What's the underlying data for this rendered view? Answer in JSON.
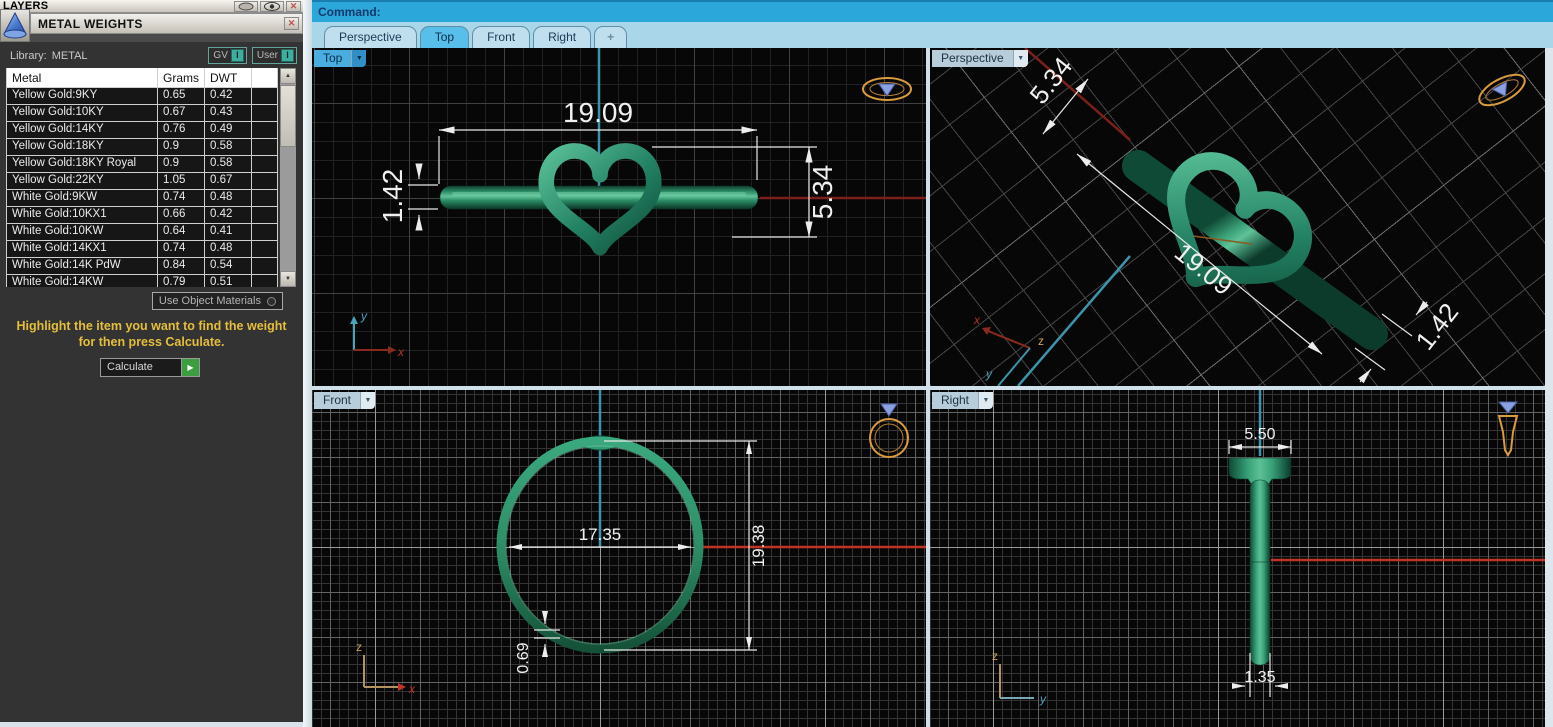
{
  "window": {
    "layers_title": "LAYERS",
    "panel_title": "METAL WEIGHTS"
  },
  "panel": {
    "library_label": "Library:",
    "library_value": "METAL",
    "gv_button": "GV",
    "user_button": "User",
    "toggle_state": "I",
    "use_object_materials": "Use Object Materials",
    "instruction_line1": "Highlight the item you want to find the weight",
    "instruction_line2": "for then press Calculate.",
    "calculate_label": "Calculate"
  },
  "table": {
    "columns": [
      "Metal",
      "Grams",
      "DWT"
    ],
    "rows": [
      {
        "m": "Yellow Gold:9KY",
        "g": "0.65",
        "d": "0.42"
      },
      {
        "m": "Yellow Gold:10KY",
        "g": "0.67",
        "d": "0.43"
      },
      {
        "m": "Yellow Gold:14KY",
        "g": "0.76",
        "d": "0.49"
      },
      {
        "m": "Yellow Gold:18KY",
        "g": "0.9",
        "d": "0.58"
      },
      {
        "m": "Yellow Gold:18KY Royal",
        "g": "0.9",
        "d": "0.58"
      },
      {
        "m": "Yellow Gold:22KY",
        "g": "1.05",
        "d": "0.67"
      },
      {
        "m": "White Gold:9KW",
        "g": "0.74",
        "d": "0.48"
      },
      {
        "m": "White Gold:10KX1",
        "g": "0.66",
        "d": "0.42"
      },
      {
        "m": "White Gold:10KW",
        "g": "0.64",
        "d": "0.41"
      },
      {
        "m": "White Gold:14KX1",
        "g": "0.74",
        "d": "0.48"
      },
      {
        "m": "White Gold:14K PdW",
        "g": "0.84",
        "d": "0.54"
      },
      {
        "m": "White Gold:14KW",
        "g": "0.79",
        "d": "0.51"
      }
    ]
  },
  "command_bar": {
    "label": "Command:"
  },
  "view_tabs": {
    "perspective": "Perspective",
    "top": "Top",
    "front": "Front",
    "right": "Right",
    "add": "+"
  },
  "viewports": {
    "top": {
      "label": "Top",
      "dim_width": "19.09",
      "dim_band": "1.42",
      "dim_heart": "5.34",
      "axis_v": "y",
      "axis_h": "x"
    },
    "perspective": {
      "label": "Perspective",
      "dim_heart": "5.34",
      "dim_width": "19.09",
      "dim_band": "1.42",
      "axis_x": "x",
      "axis_z": "z",
      "axis_y": "y"
    },
    "front": {
      "label": "Front",
      "dim_inner": "17.35",
      "dim_outer": "19.38",
      "dim_thickness": "0.69",
      "axis_v": "z",
      "axis_h": "x"
    },
    "right": {
      "label": "Right",
      "dim_top": "5.50",
      "dim_bottom": "1.35",
      "axis_v": "z",
      "axis_h": "y"
    }
  },
  "icons": {
    "dropdown": "▼",
    "scroll_up": "▲",
    "scroll_down": "▼",
    "close": "✕",
    "play": "▶"
  },
  "colors": {
    "accent_cyan": "#2ba7da",
    "tab_blue": "#a9d6e8",
    "ring_green": "#2e9471",
    "dim_white": "#f0f0f0",
    "axis_red": "#c13425",
    "axis_cyan": "#3d93aa",
    "highlight_yellow": "#e5be3c"
  }
}
